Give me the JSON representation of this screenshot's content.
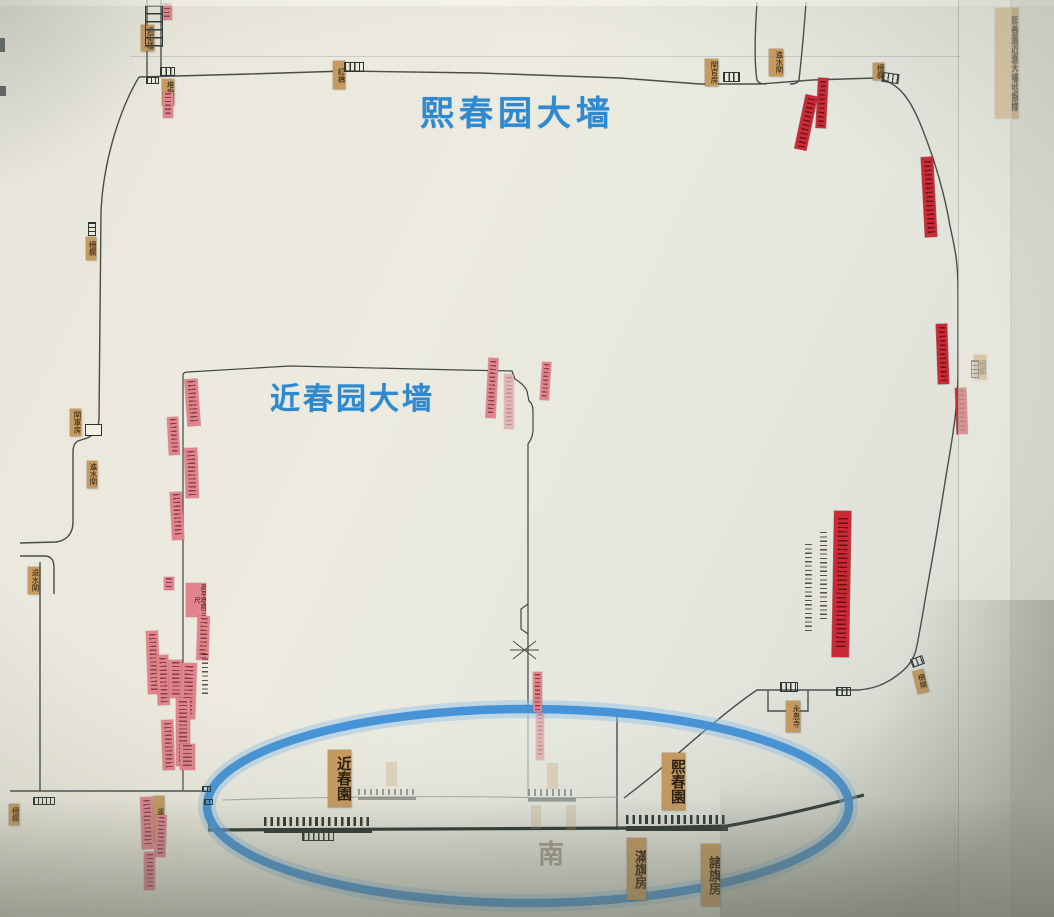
{
  "drawing": {
    "title_strip": {
      "text": "熙春園近園大墻地盤樣",
      "x": 995,
      "y": 8,
      "w": 23,
      "h": 110,
      "fs": 9.5
    },
    "highlight_color": "#3f90d6",
    "strip_color": "#e2848e",
    "red_strip_color": "#cb2936",
    "tan_label_color": "#c79a5f"
  },
  "blue_titles": [
    {
      "id": "xichun-wall",
      "text": "熙春园大墙"
    },
    {
      "id": "jinchun-wall",
      "text": "近春园大墙"
    }
  ],
  "map": {
    "tan_labels": [
      {
        "text": "過街樓",
        "x": 141,
        "y": 25,
        "w": 13,
        "h": 26
      },
      {
        "text": "堆撥房",
        "x": 162,
        "y": 79,
        "w": 12,
        "h": 26
      },
      {
        "text": "紅橋",
        "x": 333,
        "y": 61,
        "w": 12,
        "h": 28
      },
      {
        "text": "閘官房",
        "x": 705,
        "y": 59,
        "w": 13,
        "h": 27
      },
      {
        "text": "進水閘",
        "x": 769,
        "y": 49,
        "w": 14,
        "h": 27
      },
      {
        "text": "柵欄",
        "x": 873,
        "y": 63,
        "w": 11,
        "h": 17
      },
      {
        "text": "柵欄",
        "x": 86,
        "y": 237,
        "w": 10,
        "h": 23
      },
      {
        "text": "閘軍房",
        "x": 70,
        "y": 409,
        "w": 11,
        "h": 27
      },
      {
        "text": "進水閘",
        "x": 87,
        "y": 461,
        "w": 10,
        "h": 27
      },
      {
        "text": "退水閘",
        "x": 28,
        "y": 567,
        "w": 11,
        "h": 27
      },
      {
        "text": "柵欄",
        "x": 9,
        "y": 804,
        "w": 10,
        "h": 21
      },
      {
        "text": "運料門",
        "x": 153,
        "y": 796,
        "w": 11,
        "h": 46
      },
      {
        "text": "永恩寺",
        "x": 786,
        "y": 701,
        "w": 14,
        "h": 31
      },
      {
        "text": "柵欄",
        "x": 915,
        "y": 670,
        "w": 11,
        "h": 23,
        "rot": -14
      },
      {
        "text": "柵欄",
        "x": 974,
        "y": 355,
        "w": 12,
        "h": 24
      },
      {
        "text": "近春園",
        "x": 328,
        "y": 750,
        "w": 23,
        "h": 57,
        "fs": 15,
        "big": true
      },
      {
        "text": "熙春園",
        "x": 662,
        "y": 753,
        "w": 23,
        "h": 57,
        "fs": 15,
        "big": true
      },
      {
        "text": "滿旗房",
        "x": 627,
        "y": 838,
        "w": 19,
        "h": 62,
        "fs": 13,
        "big": true
      },
      {
        "text": "諸旗房",
        "x": 701,
        "y": 844,
        "w": 19,
        "h": 62,
        "fs": 13,
        "big": true
      }
    ],
    "ghost_labels": [
      {
        "text": "",
        "x": 547,
        "y": 763,
        "w": 11,
        "h": 26
      },
      {
        "text": "",
        "x": 531,
        "y": 805,
        "w": 10,
        "h": 24
      },
      {
        "text": "",
        "x": 566,
        "y": 805,
        "w": 10,
        "h": 26
      },
      {
        "text": "",
        "x": 386,
        "y": 762,
        "w": 11,
        "h": 24
      },
      {
        "text": "南",
        "x": 538,
        "y": 834,
        "w": 26,
        "h": 30,
        "char": true
      }
    ],
    "pink_strips": [
      {
        "text": "",
        "x": 162,
        "y": 3,
        "w": 10,
        "h": 17
      },
      {
        "text": "",
        "x": 163,
        "y": 92,
        "w": 10,
        "h": 26
      },
      {
        "text": "",
        "x": 186,
        "y": 379,
        "w": 13,
        "h": 47,
        "rot": -4
      },
      {
        "text": "",
        "x": 168,
        "y": 417,
        "w": 11,
        "h": 38,
        "rot": -3
      },
      {
        "text": "",
        "x": 185,
        "y": 448,
        "w": 13,
        "h": 50,
        "rot": -2
      },
      {
        "text": "",
        "x": 171,
        "y": 492,
        "w": 12,
        "h": 48,
        "rot": -3
      },
      {
        "text": "",
        "x": 164,
        "y": 577,
        "w": 10,
        "h": 13
      },
      {
        "text": "高平墻降三尺",
        "x": 186,
        "y": 583,
        "w": 20,
        "h": 34
      },
      {
        "text": "",
        "x": 197,
        "y": 616,
        "w": 12,
        "h": 44,
        "rot": 2
      },
      {
        "text": "",
        "x": 147,
        "y": 631,
        "w": 12,
        "h": 63,
        "rot": -2
      },
      {
        "text": "",
        "x": 157,
        "y": 655,
        "w": 12,
        "h": 50,
        "rot": -2
      },
      {
        "text": "",
        "x": 169,
        "y": 660,
        "w": 13,
        "h": 38
      },
      {
        "text": "",
        "x": 181,
        "y": 663,
        "w": 15,
        "h": 56,
        "rot": 2
      },
      {
        "text": "",
        "x": 176,
        "y": 698,
        "w": 14,
        "h": 68
      },
      {
        "text": "",
        "x": 162,
        "y": 720,
        "w": 12,
        "h": 50,
        "rot": -2
      },
      {
        "text": "",
        "x": 180,
        "y": 744,
        "w": 15,
        "h": 26
      },
      {
        "text": "",
        "x": 141,
        "y": 797,
        "w": 12,
        "h": 52,
        "rot": -2
      },
      {
        "text": "",
        "x": 155,
        "y": 815,
        "w": 11,
        "h": 42,
        "rot": 2
      },
      {
        "text": "",
        "x": 144,
        "y": 852,
        "w": 11,
        "h": 38
      },
      {
        "text": "",
        "x": 487,
        "y": 358,
        "w": 10,
        "h": 60,
        "rot": 3
      },
      {
        "text": "",
        "x": 504,
        "y": 374,
        "w": 10,
        "h": 55,
        "faint": true
      },
      {
        "text": "",
        "x": 541,
        "y": 362,
        "w": 9,
        "h": 38,
        "rot": 4
      },
      {
        "text": "",
        "x": 533,
        "y": 672,
        "w": 9,
        "h": 40
      },
      {
        "text": "",
        "x": 536,
        "y": 712,
        "w": 8,
        "h": 48,
        "faint": true
      }
    ],
    "red_strips": [
      {
        "text": "",
        "x": 800,
        "y": 95,
        "w": 12,
        "h": 55,
        "rot": 12
      },
      {
        "text": "",
        "x": 817,
        "y": 78,
        "w": 10,
        "h": 50,
        "rot": 3
      },
      {
        "text": "",
        "x": 923,
        "y": 157,
        "w": 12,
        "h": 80,
        "rot": -3
      },
      {
        "text": "",
        "x": 937,
        "y": 324,
        "w": 11,
        "h": 60,
        "rot": -2
      },
      {
        "text": "",
        "x": 956,
        "y": 388,
        "w": 11,
        "h": 46,
        "rot": -2
      },
      {
        "text": "",
        "x": 833,
        "y": 511,
        "w": 17,
        "h": 146,
        "rot": 1
      }
    ],
    "ink_notes": [
      {
        "x": 802,
        "y": 540,
        "w": 13,
        "h": 98
      },
      {
        "x": 817,
        "y": 528,
        "w": 14,
        "h": 97
      },
      {
        "x": 199,
        "y": 652,
        "w": 12,
        "h": 44
      }
    ],
    "icons": [
      {
        "type": "ladder",
        "x": 145,
        "y": 5,
        "w": 18,
        "h": 42
      },
      {
        "type": "building",
        "x": 160,
        "y": 67,
        "w": 15,
        "h": 9
      },
      {
        "type": "fence-h",
        "x": 146,
        "y": 77,
        "w": 13,
        "h": 7
      },
      {
        "type": "building",
        "x": 344,
        "y": 62,
        "w": 20,
        "h": 10
      },
      {
        "type": "building",
        "x": 723,
        "y": 72,
        "w": 17,
        "h": 10
      },
      {
        "type": "building",
        "x": 882,
        "y": 73,
        "w": 17,
        "h": 10,
        "rot": 8
      },
      {
        "type": "building-open",
        "x": 85,
        "y": 424,
        "w": 17,
        "h": 12
      },
      {
        "type": "fence-v",
        "x": 88,
        "y": 222,
        "w": 8,
        "h": 14
      },
      {
        "type": "fence-v",
        "x": 971,
        "y": 360,
        "w": 8,
        "h": 18
      },
      {
        "type": "building",
        "x": 911,
        "y": 657,
        "w": 13,
        "h": 9,
        "rot": -20
      },
      {
        "type": "building",
        "x": 836,
        "y": 687,
        "w": 15,
        "h": 9
      },
      {
        "type": "building",
        "x": 780,
        "y": 682,
        "w": 18,
        "h": 10
      },
      {
        "type": "fence-h",
        "x": 33,
        "y": 797,
        "w": 22,
        "h": 8
      },
      {
        "type": "fence-h",
        "x": 202,
        "y": 786,
        "w": 9,
        "h": 6
      },
      {
        "type": "fence-h",
        "x": 204,
        "y": 799,
        "w": 9,
        "h": 6
      },
      {
        "type": "cren-dark",
        "x": 264,
        "y": 817,
        "w": 108,
        "h": 16
      },
      {
        "type": "cren-sub",
        "x": 302,
        "y": 832,
        "w": 32,
        "h": 9
      },
      {
        "type": "cren-dark",
        "x": 626,
        "y": 815,
        "w": 102,
        "h": 16
      },
      {
        "type": "cren-light",
        "x": 358,
        "y": 789,
        "w": 58,
        "h": 11
      },
      {
        "type": "cren-light",
        "x": 528,
        "y": 789,
        "w": 48,
        "h": 13
      },
      {
        "type": "edge-mark",
        "x": 0,
        "y": 38,
        "w": 5,
        "h": 14
      },
      {
        "type": "edge-mark",
        "x": 0,
        "y": 86,
        "w": 6,
        "h": 10
      }
    ]
  }
}
